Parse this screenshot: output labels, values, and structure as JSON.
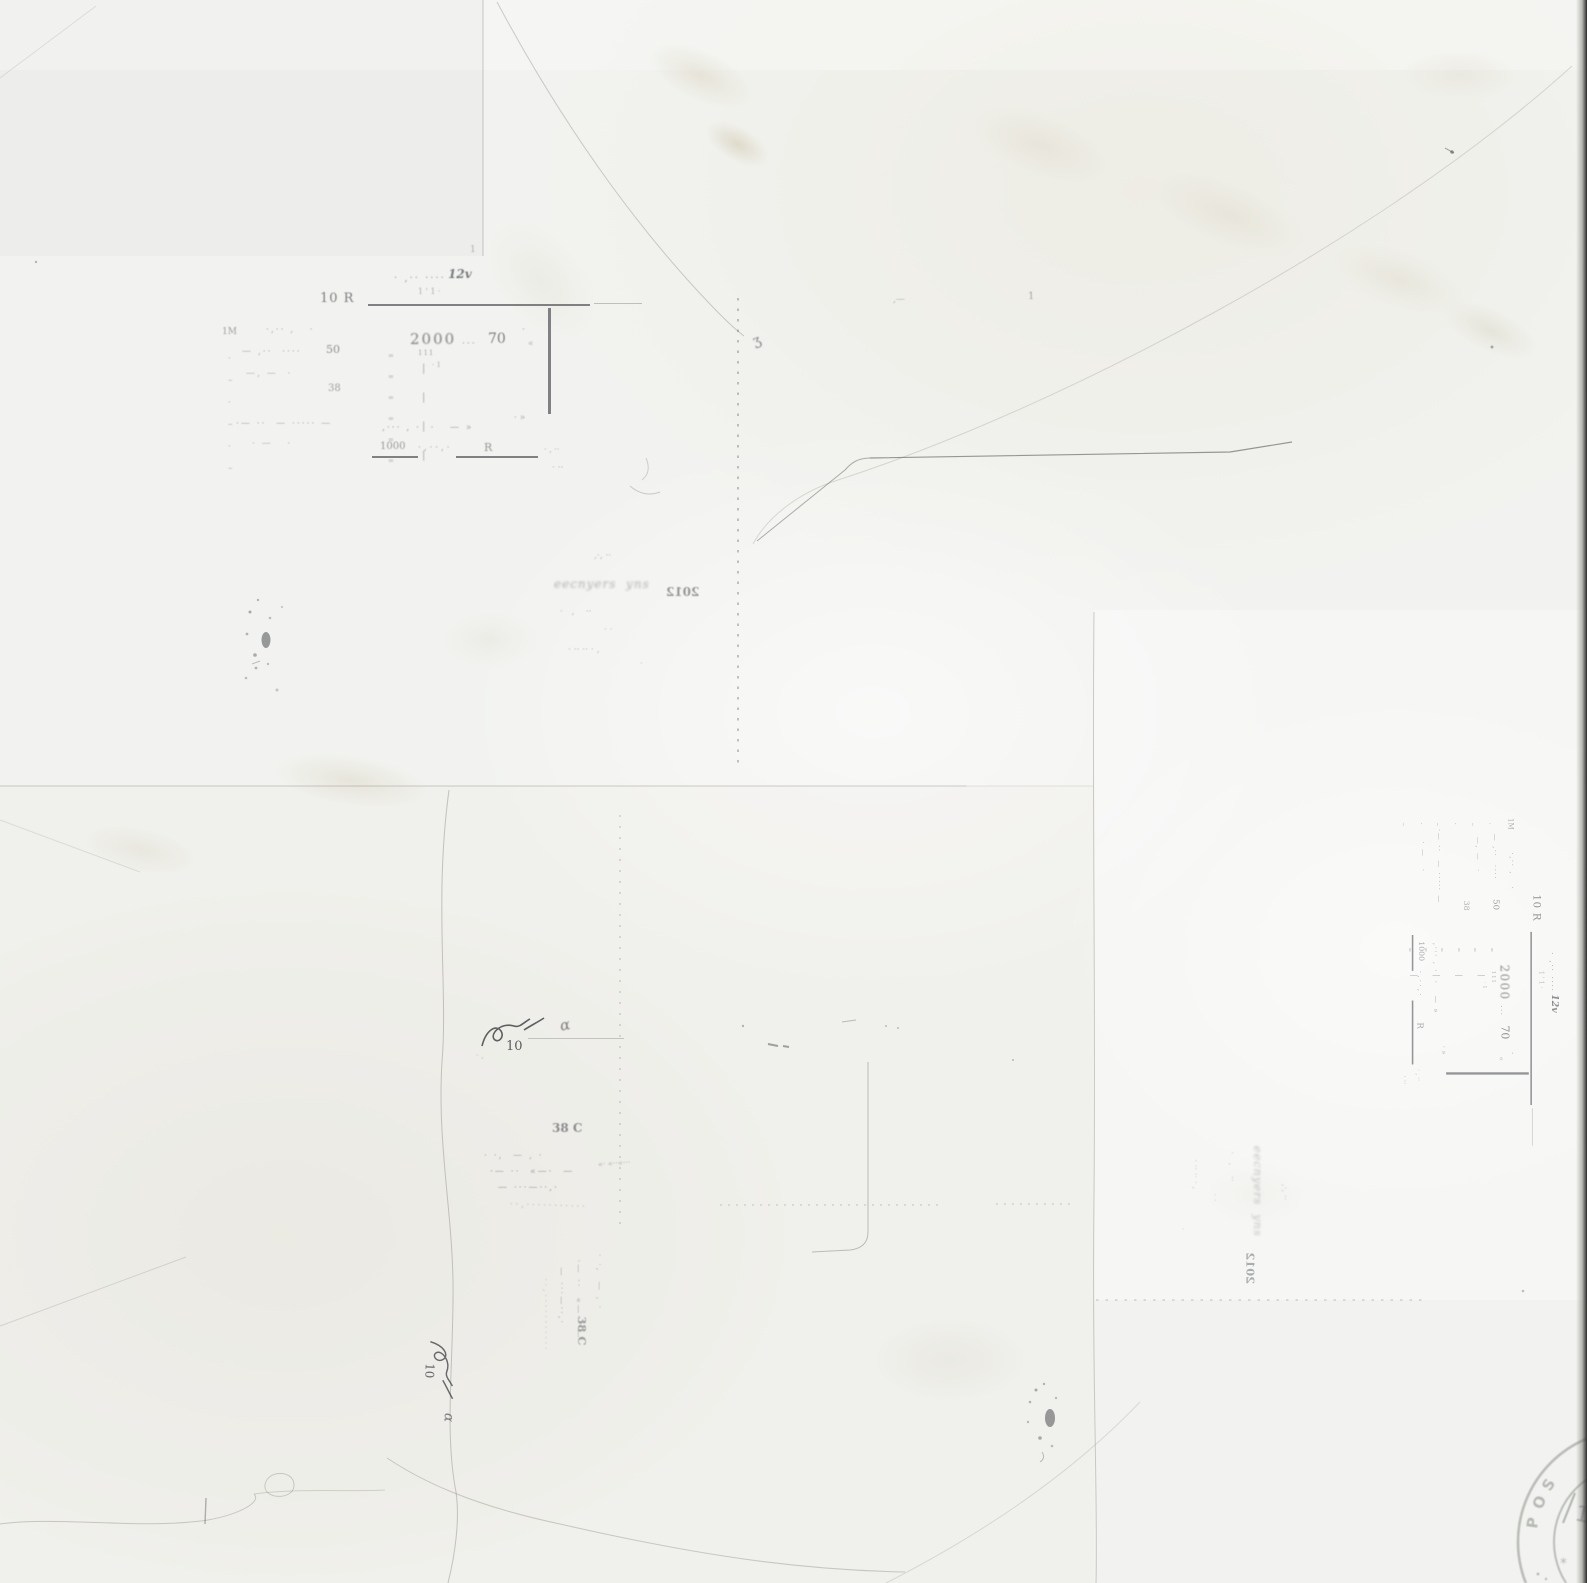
{
  "colors": {
    "paper": "#f2f3f0",
    "ink_faded": "#4a4c51",
    "postmark_gray": "#b4b7b2",
    "stain_beige": "#cfc6ab",
    "scan_edge_dark": "#2b2b29"
  },
  "form_block": {
    "note_row": "· ‚·· ···· ··",
    "note_mark": "12v",
    "note_sub": "1 ' 1 ·",
    "rate_label": "10 R",
    "margin_label": "1M",
    "tick_column": "·\n–\n·\n–\n·\n–",
    "row_1": "·‚·· ‚   ·",
    "row_2": "— ‚··  ····",
    "row_2_value": "50",
    "row_3": "—‚ —  ·",
    "row_4_value": "38",
    "row_5": "·— ··  — ····· —",
    "row_6": "· —   ·",
    "sep_ticks": "=\n=\n=\n=\n=\n=",
    "bar_ticks": "|\n|\n|\n|",
    "value_main": "2000",
    "value_sub": "111",
    "value_sub2": "· 1",
    "value_dots": "···",
    "value_right": "70",
    "value_tail": "·",
    "value_tail2": "«",
    "mark_mid": "· »",
    "row_scatter": "‚··· ‚ ·  ·   — »",
    "footer_value": "1000",
    "footer_dots": "· ‚ · · ‚ ·",
    "footer_label": "R",
    "footer_tail": "· ‚ ··",
    "below_marks": "· ··"
  },
  "script_block": {
    "dots_top": "‚·‚ ··",
    "scrawl": "eecnyers  yns",
    "digits_reversed": "2012",
    "dots_1": "·   ‚    ··",
    "dots_2": "· ·",
    "dots_3": "· ·· ·· · ‚",
    "dots_4": "·"
  },
  "hand_block": {
    "number": "10",
    "alpha_mark": "α",
    "code": "38 C",
    "row_1": "· ·‚  — ‚ ·",
    "row_2": "·— ··  «—·  —",
    "row_2_right": "«· «··«···",
    "row_3": "— ···—··‚·",
    "dotted_row": "··‚···········"
  },
  "margin_marks": {
    "jot": "ʒ",
    "dash_pair": "‚—",
    "tiny_one": "1",
    "tiny_one_upper": "1"
  },
  "postmark": {
    "letters": [
      "P",
      "O",
      "S"
    ],
    "digit": "1",
    "star": "*"
  }
}
